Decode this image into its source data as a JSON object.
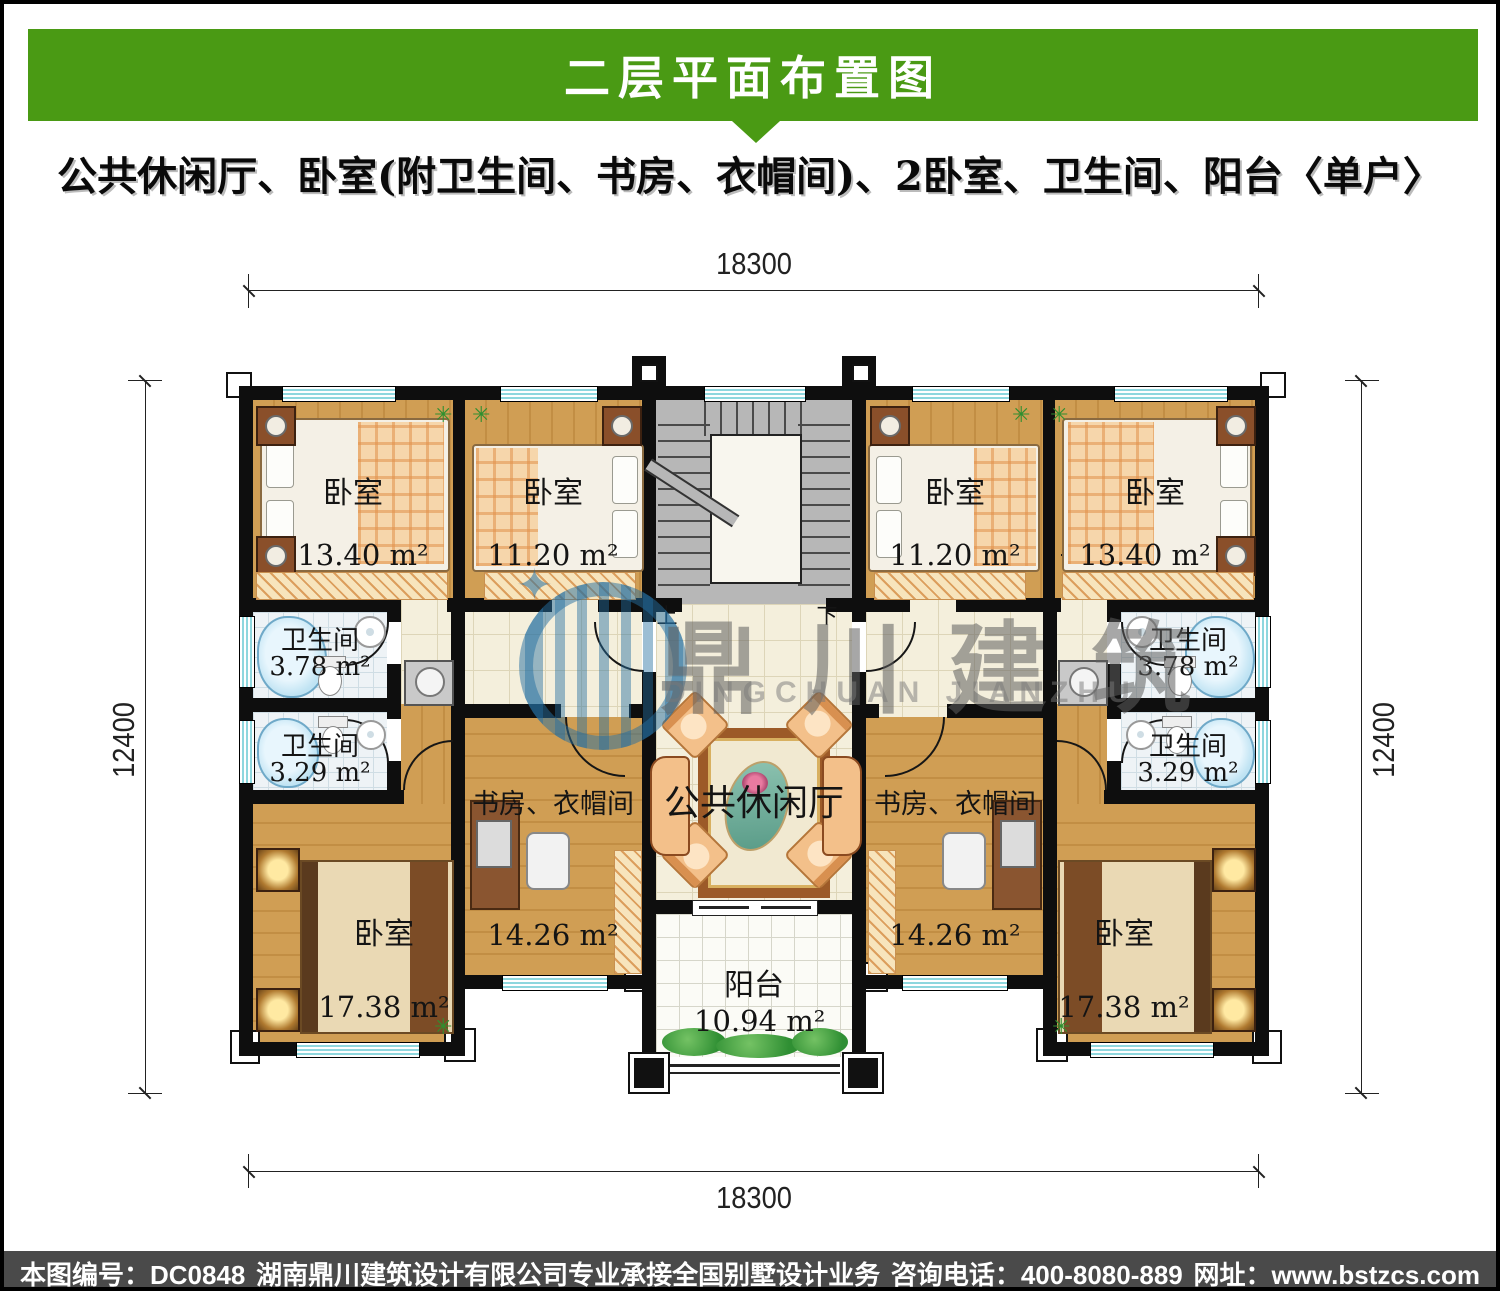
{
  "header": {
    "title": "二层平面布置图",
    "subtitle": "公共休闲厅、卧室(附卫生间、书房、衣帽间)、2卧室、卫生间、阳台〈单户〉"
  },
  "dimensions": {
    "top": "18300",
    "bottom": "18300",
    "left": "12400",
    "right": "12400"
  },
  "stairs": {
    "up": "上",
    "down": "下"
  },
  "rooms": {
    "bedroom_top_left": {
      "label": "卧室",
      "area": "13.40 m²"
    },
    "bedroom_top_left_inner": {
      "label": "卧室",
      "area": "11.20 m²"
    },
    "bedroom_top_right_inner": {
      "label": "卧室",
      "area": "11.20 m²"
    },
    "bedroom_top_right": {
      "label": "卧室",
      "area": "13.40 m²"
    },
    "bath_left_upper": {
      "label": "卫生间",
      "area": "3.78 m²"
    },
    "bath_left_lower": {
      "label": "卫生间",
      "area": "3.29 m²"
    },
    "bath_right_upper": {
      "label": "卫生间",
      "area": "3.78 m²"
    },
    "bath_right_lower": {
      "label": "卫生间",
      "area": "3.29 m²"
    },
    "study_left": {
      "label": "书房、衣帽间",
      "area": "14.26 m²"
    },
    "study_right": {
      "label": "书房、衣帽间",
      "area": "14.26 m²"
    },
    "bedroom_bottom_left": {
      "label": "卧室",
      "area": "17.38 m²"
    },
    "bedroom_bottom_right": {
      "label": "卧室",
      "area": "17.38 m²"
    },
    "lounge": {
      "label": "公共休闲厅"
    },
    "balcony": {
      "label": "阳台",
      "area": "10.94 m²"
    }
  },
  "icons": {
    "plant": "✳"
  },
  "watermark": {
    "cn": "鼎川建筑",
    "en": "DINGCHUAN JIANZHU"
  },
  "footer": {
    "drawing_no": "本图编号：DC0848",
    "company": "湖南鼎川建筑设计有限公司专业承接全国别墅设计业务",
    "phone": "咨询电话：400-8080-889",
    "website": "网址：www.bstzcs.com"
  },
  "colors": {
    "banner_green": "#4a9a14",
    "footer_gray": "#4a4a4a",
    "wall_black": "#0e0e0e",
    "wood": "#d09e54",
    "tile_cream": "#f4efdc",
    "bath_blue": "#bfe3f3",
    "window_cyan": "#8ed7de"
  }
}
